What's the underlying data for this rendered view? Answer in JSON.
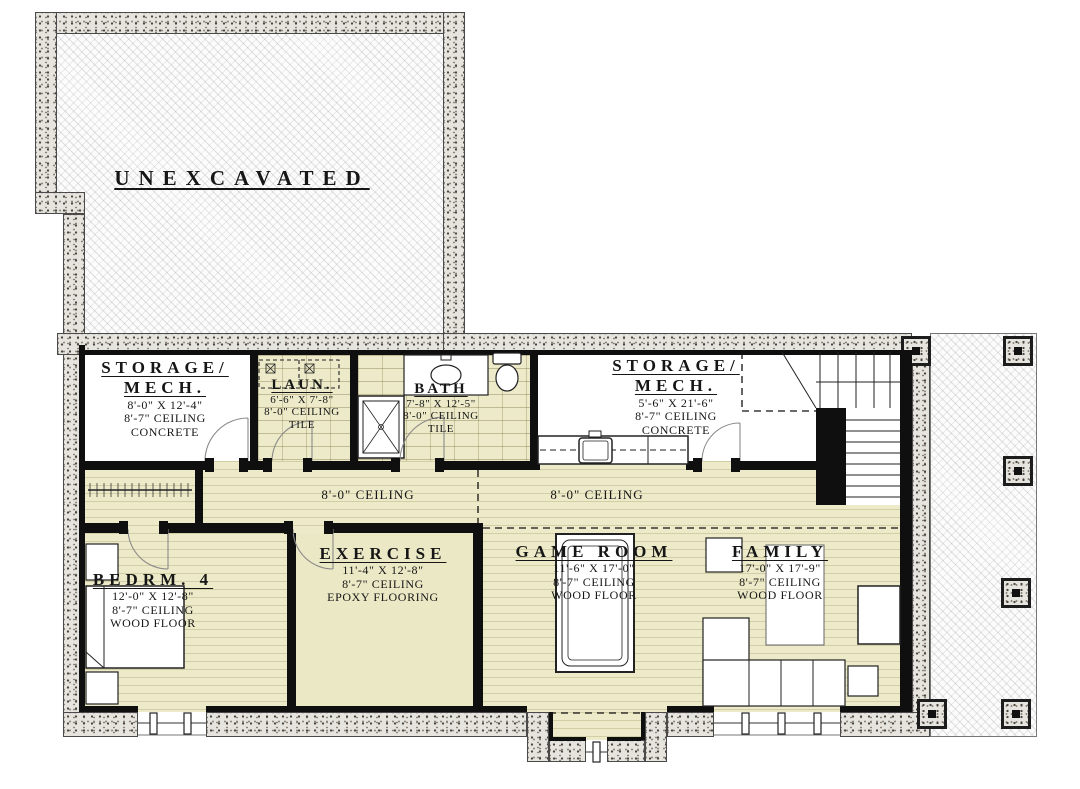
{
  "rooms": {
    "unexcavated": {
      "name": "UNEXCAVATED"
    },
    "storage_mech_1": {
      "name_line1": "STORAGE/",
      "name_line2": "MECH.",
      "dims": "8'-0\" X 12'-4\"",
      "ceiling": "8'-7\" CEILING",
      "floor": "CONCRETE"
    },
    "laundry": {
      "name": "LAUN.",
      "dims": "6'-6\" X 7'-8\"",
      "ceiling": "8'-0\" CEILING",
      "floor": "TILE"
    },
    "bath": {
      "name": "BATH",
      "dims": "7'-8\" X 12'-5\"",
      "ceiling": "8'-0\" CEILING",
      "floor": "TILE"
    },
    "storage_mech_2": {
      "name_line1": "STORAGE/",
      "name_line2": "MECH.",
      "dims": "5'-6\" X 21'-6\"",
      "ceiling": "8'-7\" CEILING",
      "floor": "CONCRETE"
    },
    "bedroom4": {
      "name": "BEDRM. 4",
      "dims": "12'-0\" X 12'-8\"",
      "ceiling": "8'-7\" CEILING",
      "floor": "WOOD FLOOR"
    },
    "exercise": {
      "name": "EXERCISE",
      "dims": "11'-4\" X 12'-8\"",
      "ceiling": "8'-7\" CEILING",
      "floor": "EPOXY FLOORING"
    },
    "game_room": {
      "name": "GAME ROOM",
      "dims": "11'-6\" X 17'-0\"",
      "ceiling": "8'-7\" CEILING",
      "floor": "WOOD FLOOR"
    },
    "family": {
      "name": "FAMILY",
      "dims": "17'-0\" X 17'-9\"",
      "ceiling": "8'-7\" CEILING",
      "floor": "WOOD FLOOR"
    }
  },
  "hallway": {
    "ceiling_left": "8'-0\" CEILING",
    "ceiling_right": "8'-0\" CEILING"
  }
}
